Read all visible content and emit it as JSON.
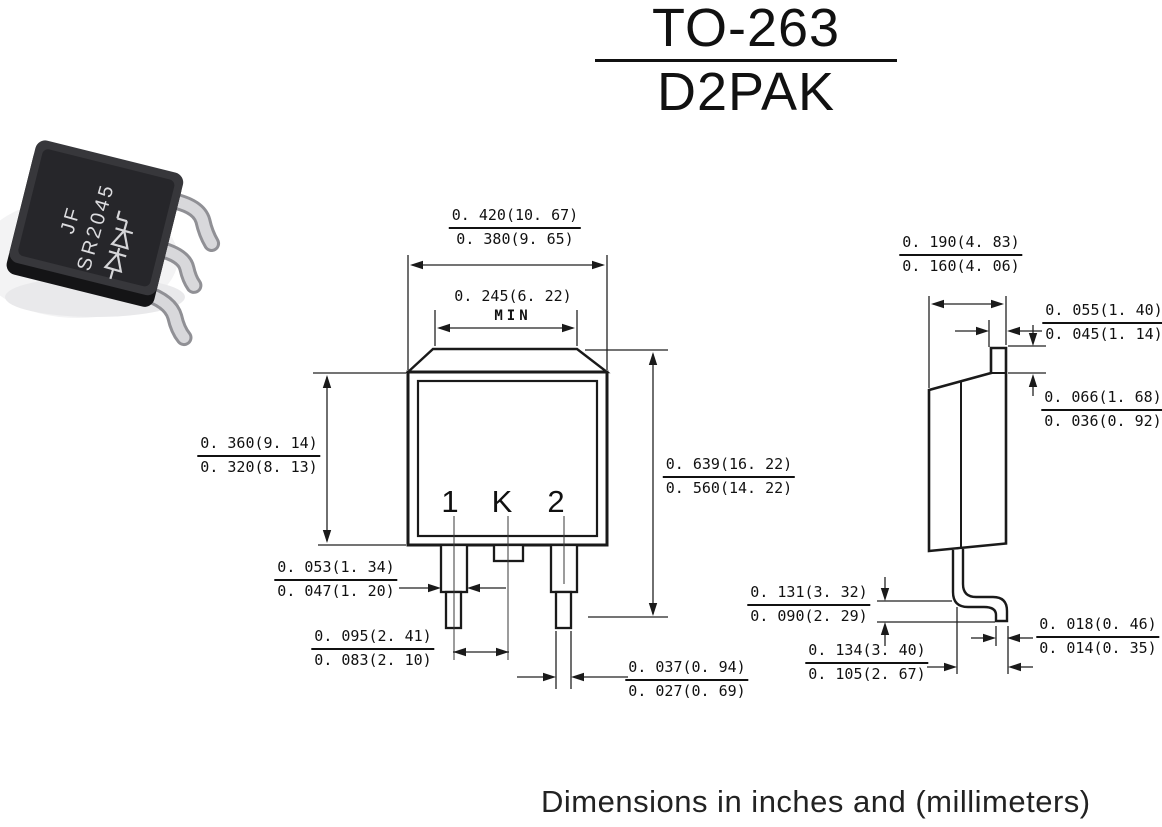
{
  "title": {
    "primary": "TO-263",
    "secondary": "D2PAK"
  },
  "caption": "Dimensions in inches and (millimeters)",
  "package_photo": {
    "marking_line1": "JF",
    "marking_line2": "SR2045"
  },
  "front_view": {
    "pin_labels": {
      "pin1": "1",
      "center_tab": "K",
      "pin2": "2"
    },
    "dims": {
      "overall_width": {
        "max": "0. 420(10. 67)",
        "min": "0. 380(9. 65)"
      },
      "tab_width": {
        "value": "0. 245(6. 22)",
        "qualifier": "MIN"
      },
      "body_height": {
        "max": "0. 360(9. 14)",
        "min": "0. 320(8. 13)"
      },
      "lead_width_upper": {
        "max": "0. 053(1. 34)",
        "min": "0. 047(1. 20)"
      },
      "lead_pitch": {
        "max": "0. 095(2. 41)",
        "min": "0. 083(2. 10)"
      },
      "overall_height": {
        "max": "0. 639(16. 22)",
        "min": "0. 560(14. 22)"
      },
      "lead_width_lower": {
        "max": "0. 037(0. 94)",
        "min": "0. 027(0. 69)"
      }
    }
  },
  "side_view": {
    "dims": {
      "body_thickness": {
        "max": "0. 190(4. 83)",
        "min": "0. 160(4. 06)"
      },
      "tab_width": {
        "max": "0. 055(1. 40)",
        "min": "0. 045(1. 14)"
      },
      "tab_height": {
        "max": "0. 066(1. 68)",
        "min": "0. 036(0. 92)"
      },
      "lead_height": {
        "max": "0. 131(3. 32)",
        "min": "0. 090(2. 29)"
      },
      "foot_length": {
        "max": "0. 134(3. 40)",
        "min": "0. 105(2. 67)"
      },
      "lead_thickness": {
        "max": "0. 018(0. 46)",
        "min": "0. 014(0. 35)"
      }
    }
  },
  "colors": {
    "line": "#1a1a1a",
    "package_body": "#2b2b2e",
    "lead_metal": "#d7d7da"
  }
}
